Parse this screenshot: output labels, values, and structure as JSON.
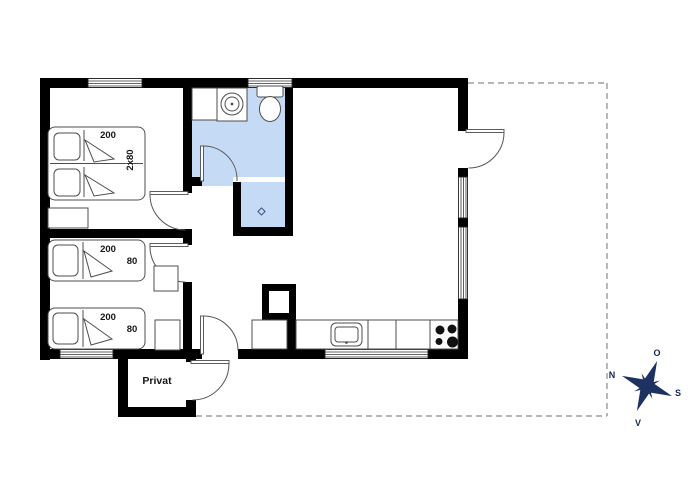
{
  "plan": {
    "rooms": {
      "privat_label": "Privat"
    },
    "beds": {
      "double": {
        "length": "200",
        "width": "2x80"
      },
      "single_top": {
        "length": "200",
        "width": "80"
      },
      "single_bottom": {
        "length": "200",
        "width": "80"
      }
    },
    "compass": {
      "north": "N",
      "east": "O",
      "south": "S",
      "west": "V"
    },
    "colors": {
      "wall": "#000000",
      "bathroom_floor": "#c5daf4",
      "compass_navy": "#1d3260",
      "furniture_line": "#4d4d4d",
      "boundary_dash": "#8a8a8a"
    }
  }
}
